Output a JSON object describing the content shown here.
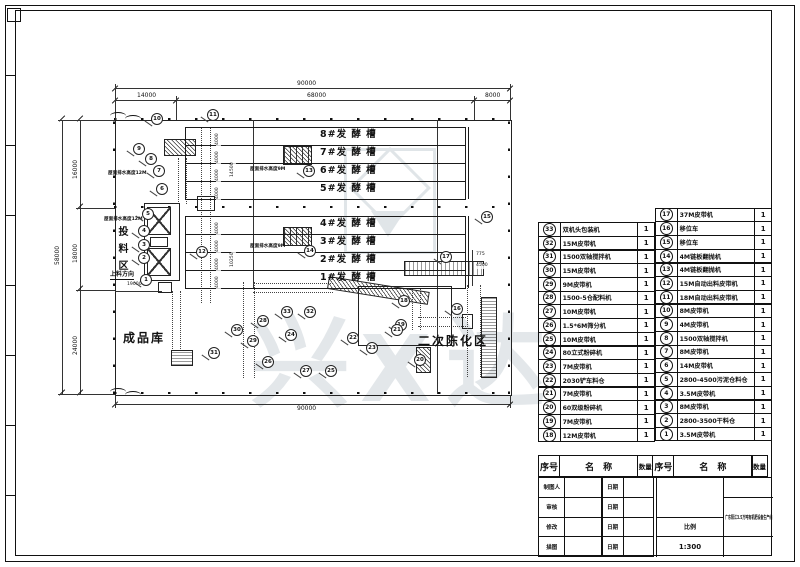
{
  "sheet": {
    "background": "#ffffff",
    "line_color": "#1a1a1a",
    "watermark_color": "#cdd4da"
  },
  "drawing": {
    "tanks_upper": [
      "8#发 酵 槽",
      "7#发 酵 槽",
      "6#发 酵 槽",
      "5#发 酵 槽"
    ],
    "tanks_lower": [
      "4#发 酵 槽",
      "3#发 酵 槽",
      "2#发 酵 槽",
      "1#发 酵 槽"
    ],
    "areas": {
      "feeding_zone": "投料区",
      "feeding_direction": "上料方向",
      "finished_store": "成品库",
      "secondary_aging": "二次陈化区"
    },
    "notes": {
      "roof_drain_12m": "屋面排水高度12M",
      "roof_drain_9m": "屋面排水高度9M"
    },
    "dims": {
      "overall_width": "90000",
      "width_segments": [
        "14000",
        "68000",
        "8000"
      ],
      "overall_height": "58000",
      "height_segments": [
        "16000",
        "18000",
        "24000"
      ],
      "bottom_width": "90000",
      "tank_width": "4000",
      "inner_a": "14500",
      "inner_b": "10250",
      "right_a": "775",
      "right_b": "4500",
      "left_small": "19000"
    },
    "balloons": [
      {
        "n": "10",
        "x": 156,
        "y": 118
      },
      {
        "n": "11",
        "x": 212,
        "y": 114
      },
      {
        "n": "9",
        "x": 138,
        "y": 148
      },
      {
        "n": "8",
        "x": 150,
        "y": 158
      },
      {
        "n": "7",
        "x": 158,
        "y": 170
      },
      {
        "n": "6",
        "x": 161,
        "y": 188
      },
      {
        "n": "5",
        "x": 147,
        "y": 213
      },
      {
        "n": "4",
        "x": 143,
        "y": 230
      },
      {
        "n": "3",
        "x": 143,
        "y": 244
      },
      {
        "n": "2",
        "x": 143,
        "y": 257
      },
      {
        "n": "1",
        "x": 145,
        "y": 279
      },
      {
        "n": "13",
        "x": 308,
        "y": 170
      },
      {
        "n": "14",
        "x": 309,
        "y": 250
      },
      {
        "n": "12",
        "x": 201,
        "y": 251
      },
      {
        "n": "15",
        "x": 486,
        "y": 216
      },
      {
        "n": "17",
        "x": 445,
        "y": 256
      },
      {
        "n": "16",
        "x": 456,
        "y": 308
      },
      {
        "n": "18",
        "x": 403,
        "y": 300
      },
      {
        "n": "19",
        "x": 400,
        "y": 324
      },
      {
        "n": "33",
        "x": 286,
        "y": 311
      },
      {
        "n": "32",
        "x": 309,
        "y": 311
      },
      {
        "n": "28",
        "x": 262,
        "y": 320
      },
      {
        "n": "30",
        "x": 236,
        "y": 329
      },
      {
        "n": "31",
        "x": 213,
        "y": 352
      },
      {
        "n": "29",
        "x": 252,
        "y": 340
      },
      {
        "n": "24",
        "x": 290,
        "y": 334
      },
      {
        "n": "26",
        "x": 267,
        "y": 361
      },
      {
        "n": "27",
        "x": 305,
        "y": 370
      },
      {
        "n": "25",
        "x": 330,
        "y": 370
      },
      {
        "n": "22",
        "x": 352,
        "y": 337
      },
      {
        "n": "23",
        "x": 371,
        "y": 347
      },
      {
        "n": "21",
        "x": 396,
        "y": 329
      },
      {
        "n": "20",
        "x": 419,
        "y": 359
      }
    ]
  },
  "parts_table": {
    "headers": [
      "序号",
      "名称",
      "数量"
    ],
    "left_rows": [
      {
        "no": "33",
        "name": "双机头包装机",
        "qty": "1"
      },
      {
        "no": "32",
        "name": "15M皮带机",
        "qty": "1"
      },
      {
        "no": "31",
        "name": "1500双轴搅拌机",
        "qty": "1"
      },
      {
        "no": "30",
        "name": "15M皮带机",
        "qty": "1"
      },
      {
        "no": "29",
        "name": "9M皮带机",
        "qty": "1"
      },
      {
        "no": "28",
        "name": "1500-5仓配料机",
        "qty": "1"
      },
      {
        "no": "27",
        "name": "10M皮带机",
        "qty": "1"
      },
      {
        "no": "26",
        "name": "1.5*6M筛分机",
        "qty": "1"
      },
      {
        "no": "25",
        "name": "10M皮带机",
        "qty": "1"
      },
      {
        "no": "24",
        "name": "80立式粉碎机",
        "qty": "1"
      },
      {
        "no": "23",
        "name": "7M皮带机",
        "qty": "1"
      },
      {
        "no": "22",
        "name": "2030铲车料仓",
        "qty": "1"
      },
      {
        "no": "21",
        "name": "7M皮带机",
        "qty": "1"
      },
      {
        "no": "20",
        "name": "60双级粉碎机",
        "qty": "1"
      },
      {
        "no": "19",
        "name": "7M皮带机",
        "qty": "1"
      },
      {
        "no": "18",
        "name": "12M皮带机",
        "qty": "1"
      }
    ],
    "right_rows": [
      {
        "no": "17",
        "name": "37M皮带机",
        "qty": "1"
      },
      {
        "no": "16",
        "name": "移位车",
        "qty": "1"
      },
      {
        "no": "15",
        "name": "移位车",
        "qty": "1"
      },
      {
        "no": "14",
        "name": "4M链板翻抛机",
        "qty": "1"
      },
      {
        "no": "13",
        "name": "4M链板翻抛机",
        "qty": "1"
      },
      {
        "no": "12",
        "name": "15M自动出料皮带机",
        "qty": "1"
      },
      {
        "no": "11",
        "name": "18M自动出料皮带机",
        "qty": "1"
      },
      {
        "no": "10",
        "name": "8M皮带机",
        "qty": "1"
      },
      {
        "no": "9",
        "name": "4M皮带机",
        "qty": "1"
      },
      {
        "no": "8",
        "name": "1500双轴搅拌机",
        "qty": "1"
      },
      {
        "no": "7",
        "name": "8M皮带机",
        "qty": "1"
      },
      {
        "no": "6",
        "name": "14M皮带机",
        "qty": "1"
      },
      {
        "no": "5",
        "name": "2800-4500污泥仓料仓",
        "qty": "1"
      },
      {
        "no": "4",
        "name": "3.5M皮带机",
        "qty": "1"
      },
      {
        "no": "3",
        "name": "8M皮带机",
        "qty": "1"
      },
      {
        "no": "2",
        "name": "2800-3500干料仓",
        "qty": "1"
      },
      {
        "no": "1",
        "name": "3.5M皮带机",
        "qty": "1"
      }
    ]
  },
  "title_block": {
    "rows": [
      {
        "label": "制图人",
        "date": "日期"
      },
      {
        "label": "审核",
        "date": "日期"
      },
      {
        "label": "修改",
        "date": "日期"
      },
      {
        "label": "描图",
        "date": "日期"
      }
    ],
    "scale_label": "比例",
    "scale_value": "1:300",
    "project": "广东阳江3.5万吨有机肥设备生产线"
  },
  "watermark": {
    "char_left": "兴",
    "char_mid": "X",
    "char_right": "达"
  }
}
